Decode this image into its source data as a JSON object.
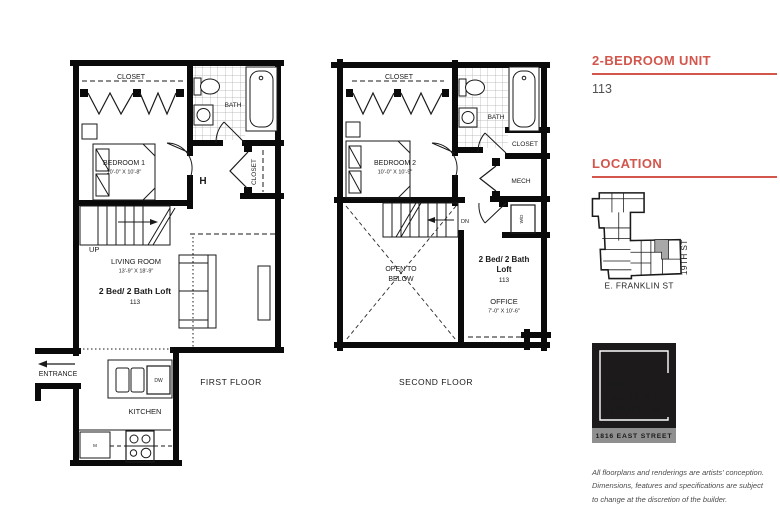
{
  "sidebar": {
    "unit_heading": "2-BEDROOM UNIT",
    "unit_number": "113",
    "location_heading": "LOCATION",
    "map": {
      "street_side": "19TH ST",
      "street_bottom": "E. FRANKLIN ST"
    },
    "logo": {
      "line1": "THE",
      "line2": "LOFTS AT",
      "line3": "FRANKLIN",
      "address": "1816 EAST STREET"
    },
    "disclaimer": {
      "line1": "All floorplans and renderings are artists' conception.",
      "line2": "Dimensions, features and specifications are subject",
      "line3": "to change at the discretion of the builder."
    }
  },
  "first_floor": {
    "caption": "FIRST FLOOR",
    "labels": {
      "closet_top": "CLOSET",
      "bath": "BATH",
      "closet_side": "CLOSET",
      "bedroom": "BEDROOM 1",
      "bedroom_dim": "10'-0\" X 10'-8\"",
      "door_h": "H",
      "up": "UP",
      "living": "LIVING ROOM",
      "living_dim": "13'-9\" X 18'-9\"",
      "unit_type": "2 Bed/ 2 Bath Loft",
      "unit_number": "113",
      "entrance": "ENTRANCE",
      "kitchen": "KITCHEN",
      "dishwasher": "DW",
      "microwave": "M"
    }
  },
  "second_floor": {
    "caption": "SECOND FLOOR",
    "labels": {
      "closet_top": "CLOSET",
      "bath": "BATH",
      "closet_side": "CLOSET",
      "mech": "MECH",
      "bedroom": "BEDROOM 2",
      "bedroom_dim": "10'-0\" X 10'-9\"",
      "dn": "DN",
      "open_below_line1": "OPEN TO",
      "open_below_line2": "BELOW",
      "washer_dryer": "W/D",
      "unit_type_line1": "2 Bed/ 2 Bath",
      "unit_type_line2": "Loft",
      "unit_number": "113",
      "office": "OFFICE",
      "office_dim": "7'-0\" X 10'-6\""
    }
  },
  "colors": {
    "accent_red": "#d2564c",
    "heading_gray": "#4f5052",
    "logo_black": "#1d1a1b",
    "logo_bar_gray": "#8f8f90",
    "map_unit_highlight": "#a8a8a8",
    "wall_black": "#0a0a0a"
  }
}
